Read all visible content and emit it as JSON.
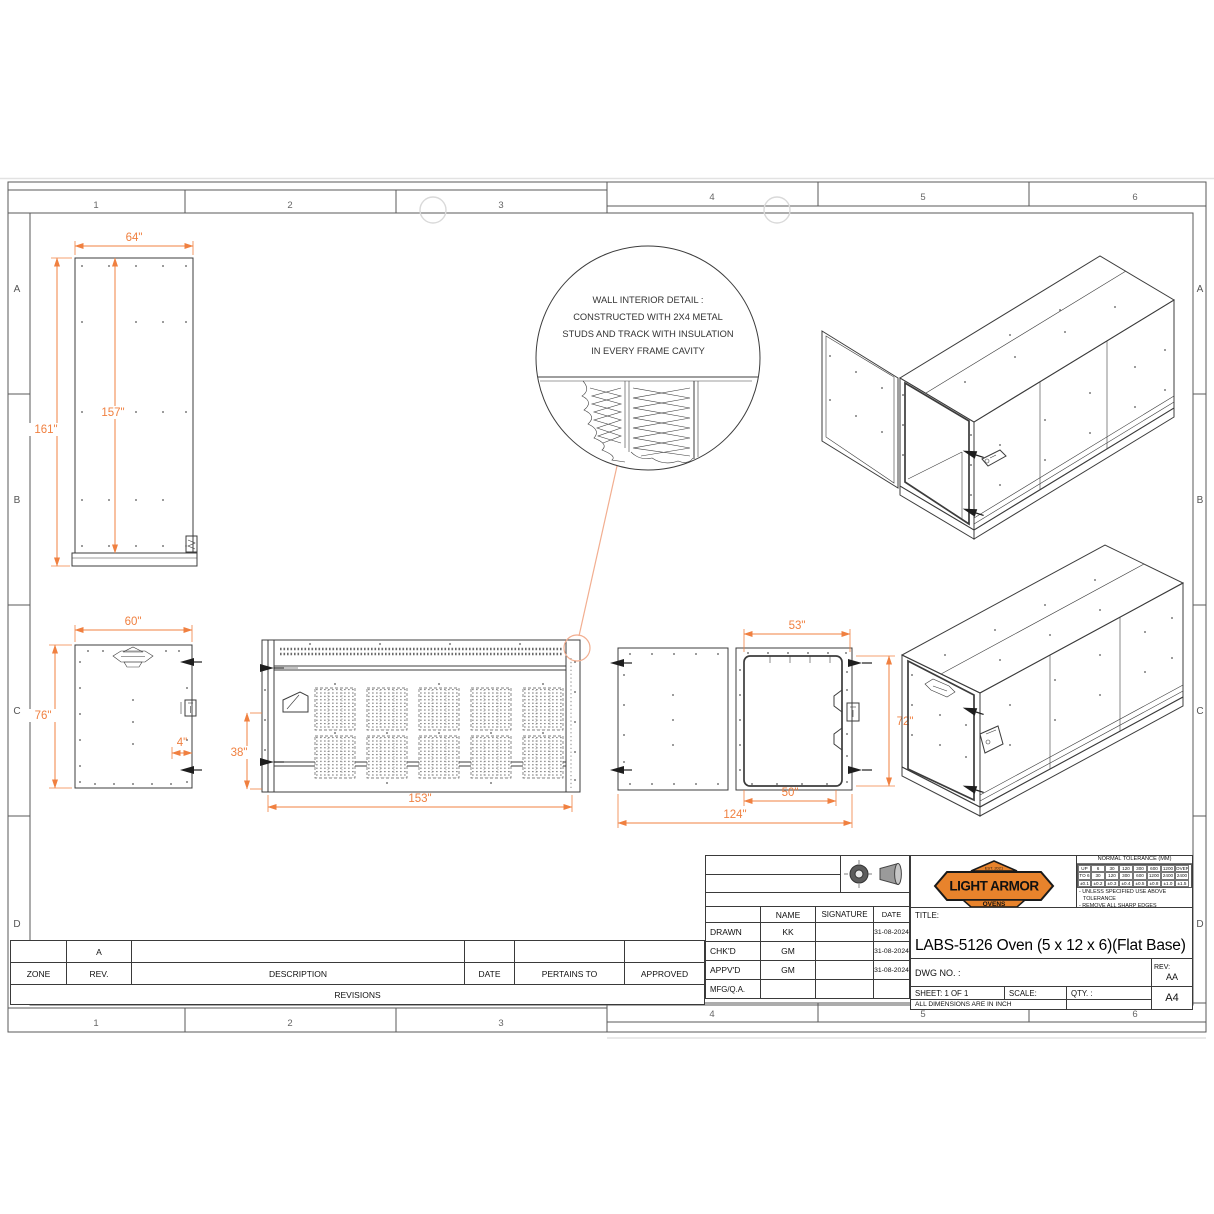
{
  "frame": {
    "zones": [
      "1",
      "2",
      "3",
      "4",
      "5",
      "6"
    ],
    "rows": [
      "A",
      "B",
      "C",
      "D"
    ]
  },
  "detail_callout": {
    "line1": "WALL INTERIOR DETAIL :",
    "line2": "CONSTRUCTED WITH 2X4 METAL",
    "line3": "STUDS AND TRACK WITH INSULATION",
    "line4": "IN EVERY FRAME CAVITY"
  },
  "views": {
    "side": {
      "width": "64\"",
      "height_outer": "161\"",
      "height_inner": "157\""
    },
    "door": {
      "width": "60\"",
      "height": "76\"",
      "inset": "4\""
    },
    "front": {
      "width": "153\"",
      "height": "38\""
    },
    "plan": {
      "door_top": "53\"",
      "door_bottom": "50\"",
      "width": "124\"",
      "height": "72\""
    }
  },
  "palette": {
    "dimension": "#F08040",
    "logo_orange": "#E8832C"
  },
  "title_block": {
    "approvals": {
      "col_name": "NAME",
      "col_signature": "SIGNATURE",
      "col_date": "DATE",
      "rows": [
        {
          "label": "DRAWN",
          "name": "KK",
          "date": "31-08-2024"
        },
        {
          "label": "CHK'D",
          "name": "GM",
          "date": "31-08-2024"
        },
        {
          "label": "APPV'D",
          "name": "GM",
          "date": "31-08-2024"
        },
        {
          "label": "MFG/Q.A.",
          "name": "",
          "date": ""
        }
      ]
    },
    "logo": {
      "est": "EST. 2021",
      "line1": "LIGHT ARMOR",
      "line2": "OVENS"
    },
    "tolerance": {
      "title": "NORMAL TOLERANCE (MM)",
      "h1": [
        "UP",
        "6",
        "30",
        "120",
        "300",
        "600",
        "1200",
        "OVER"
      ],
      "h2": [
        "TO 6",
        "30",
        "120",
        "300",
        "600",
        "1200",
        "2400",
        "2400"
      ],
      "v": [
        "±0.1",
        "±0.2",
        "±0.3",
        "±0.4",
        "±0.5",
        "±0.8",
        "±1.0",
        "±1.5"
      ],
      "note1": "- UNLESS SPECIFIED USE ABOVE",
      "note2": "  TOLERANCE",
      "note3": "- REMOVE ALL SHARP EDGES"
    },
    "title_label": "TITLE:",
    "title": "LABS-5126 Oven (5 x 12 x 6)(Flat Base)",
    "dwg_no_label": "DWG NO. :",
    "rev_label": "REV:",
    "rev_value": "AA",
    "sheet": "SHEET: 1 OF 1",
    "scale_label": "SCALE:",
    "qty_label": "QTY. :",
    "dims_note": "ALL DIMENSIONS ARE IN INCH",
    "size": "A4"
  },
  "revisions": {
    "pending_rev": "A",
    "headers": [
      "ZONE",
      "REV.",
      "DESCRIPTION",
      "DATE",
      "PERTAINS TO",
      "APPROVED"
    ],
    "footer": "REVISIONS"
  }
}
